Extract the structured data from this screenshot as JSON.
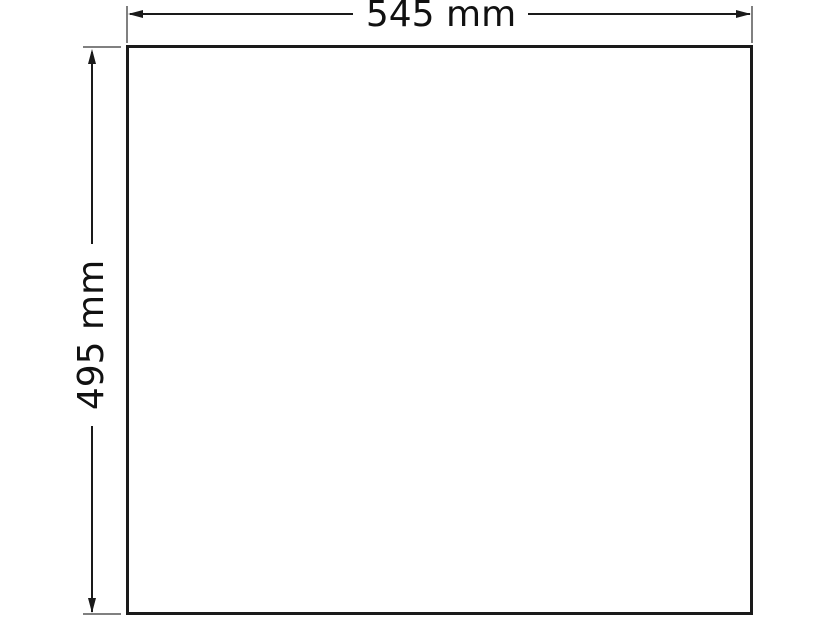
{
  "diagram": {
    "type": "technical-dimension-drawing",
    "shape": "rectangle",
    "top_dimension": {
      "label": "545 mm",
      "value_mm": 545,
      "orientation": "horizontal"
    },
    "left_dimension": {
      "label": "495 mm",
      "value_mm": 495,
      "orientation": "vertical-rotated"
    }
  },
  "theme": {
    "line_color": "#1a1a1a",
    "extension_line_color": "#808080",
    "background": "#ffffff",
    "text_color": "#111111"
  }
}
